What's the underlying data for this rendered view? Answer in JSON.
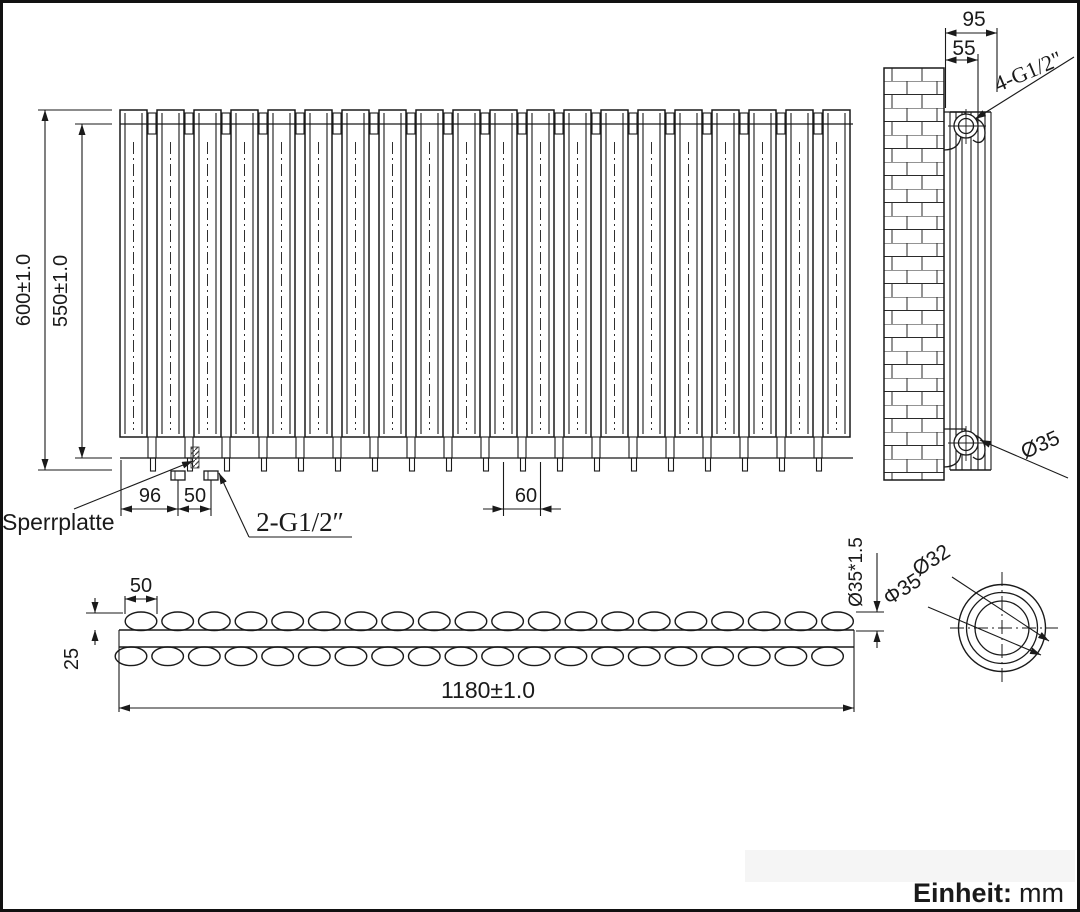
{
  "drawing_title": "radiator-technical-drawing",
  "colors": {
    "line": "#1a1a1a",
    "accent_blue": "#2121cc"
  },
  "front_view": {
    "tube_count": 20,
    "dims": {
      "height_overall": "600±1.0",
      "height_inner": "550±1.0",
      "foot_offset": "96",
      "foot_spacing": "50",
      "tube_pitch": "60"
    },
    "labels": {
      "locking_plate": "Sperrplatte",
      "connection": "2-G1/2″"
    }
  },
  "side_view": {
    "dims": {
      "depth_overall": "95",
      "wall_to_axis": "55"
    },
    "labels": {
      "connection": "4-G1/2\"",
      "pipe_diameter": "Ø35"
    }
  },
  "plan_view": {
    "ovals_per_row": 20,
    "dims": {
      "oval_length": "50",
      "row_offset": "25",
      "length_overall": "1180±1.0",
      "tube_spec": "Ø35*1.5"
    }
  },
  "detail_view": {
    "labels": {
      "inner_diameter": "Ø32",
      "outer_diameter": "Φ35"
    }
  },
  "unit_note": {
    "label": "Einheit:",
    "value": "mm"
  }
}
